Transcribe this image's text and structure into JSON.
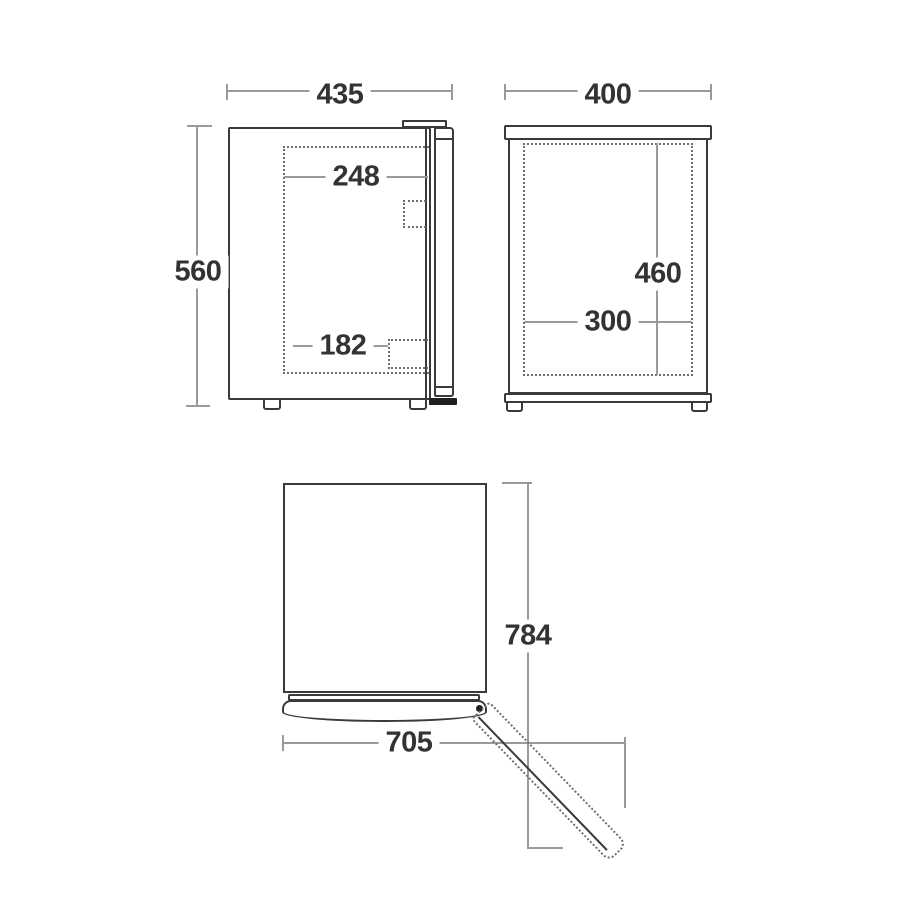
{
  "views": {
    "front": {
      "width": "435",
      "height": "560",
      "inner_width": "248",
      "inner_offset": "182"
    },
    "side": {
      "depth": "400",
      "inner_height": "460",
      "inner_depth": "300"
    },
    "top": {
      "door_open_depth": "784",
      "width_with_door": "705"
    }
  },
  "colors": {
    "outline": "#3a3a3a",
    "dashed_line": "#6e6e6e",
    "dimension_line": "#9a9a9a",
    "label_text": "#333333",
    "hinge_dot": "#1e1e1e",
    "background": "#ffffff"
  }
}
